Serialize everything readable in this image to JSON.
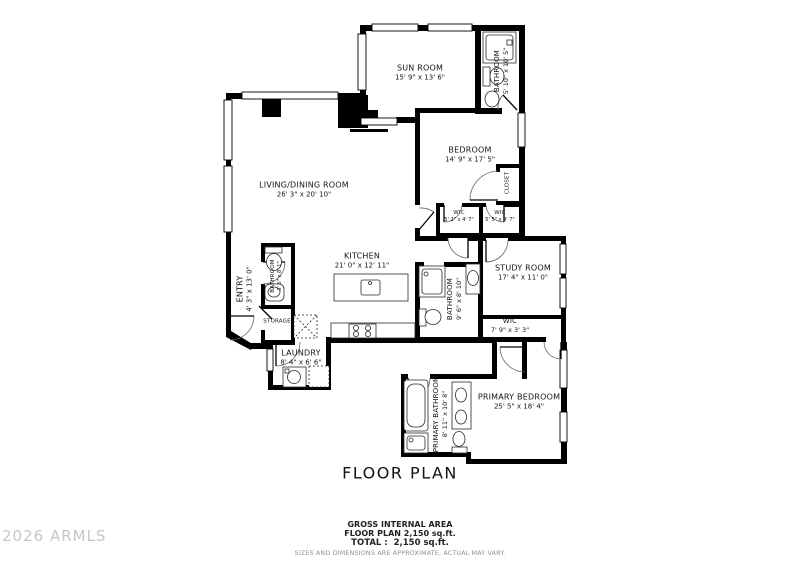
{
  "title": "FLOOR PLAN",
  "watermark": "2026 ARMLS",
  "footer": {
    "area_header": "GROSS INTERNAL AREA",
    "floor_plan_area": "FLOOR PLAN 2,150 sq.ft.",
    "total_area": "TOTAL :  2,150 sq.ft.",
    "disclaimer": "SIZES AND DIMENSIONS ARE APPROXIMATE, ACTUAL MAY VARY."
  },
  "colors": {
    "wall": "#000000",
    "text": "#141414",
    "watermark": "#c6c6c6",
    "muted": "#8f8f8f"
  },
  "rooms": [
    {
      "name": "SUN ROOM",
      "dims": "15' 9\" x 13' 6\""
    },
    {
      "name": "BATHROOM",
      "dims": "5' 10\" x 10' 5\""
    },
    {
      "name": "BEDROOM",
      "dims": "14' 9\" x 17' 5\""
    },
    {
      "name": "CLOSET",
      "dims": ""
    },
    {
      "name": "WIC",
      "dims": "5' 2\" x 4' 7\""
    },
    {
      "name": "WIC",
      "dims": "5' 5\" x 4' 7\""
    },
    {
      "name": "LIVING/DINING ROOM",
      "dims": "26' 3\" x 20' 10\""
    },
    {
      "name": "KITCHEN",
      "dims": "21' 0\" x 12' 11\""
    },
    {
      "name": "ENTRY",
      "dims": "4' 3\" x 13' 0\""
    },
    {
      "name": "BATHROOM",
      "dims": "3' 6\" x 8' 1\""
    },
    {
      "name": "STORAGE",
      "dims": ""
    },
    {
      "name": "STUDY ROOM",
      "dims": "17' 4\" x 11' 0\""
    },
    {
      "name": "BATHROOM",
      "dims": "9' 6\" x 8' 10\""
    },
    {
      "name": "WIC",
      "dims": "7' 9\" x 3' 3\""
    },
    {
      "name": "LAUNDRY",
      "dims": "8' 4\" x 6' 6\""
    },
    {
      "name": "PRIMARY BATHROOM",
      "dims": "8' 11\" x 10' 8\""
    },
    {
      "name": "PRIMARY BEDROOM",
      "dims": "25' 5\" x 18' 4\""
    }
  ]
}
